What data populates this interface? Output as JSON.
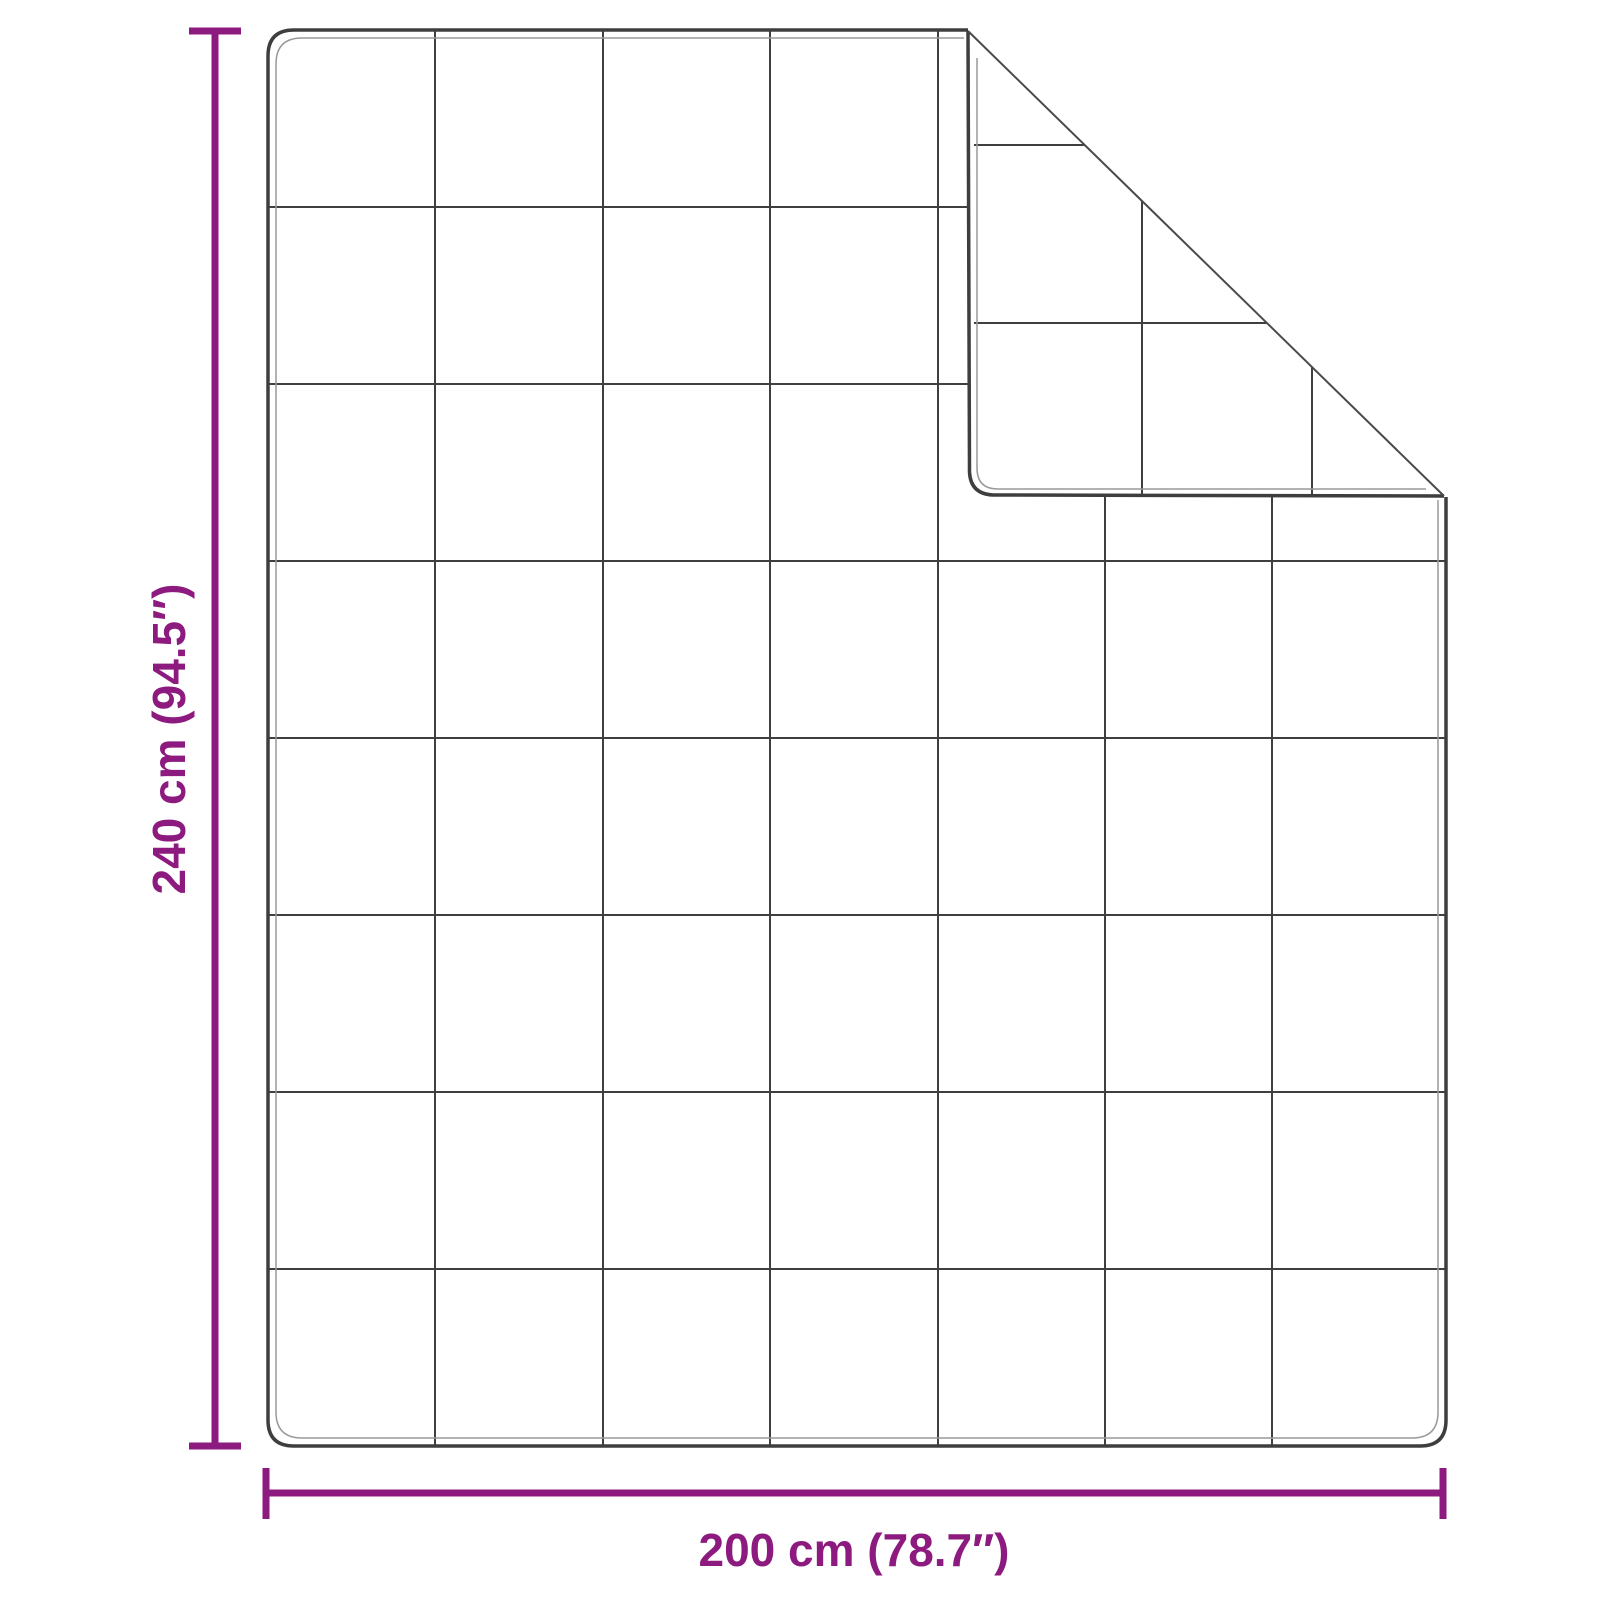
{
  "diagram": {
    "name": "blanket-dimension-diagram",
    "description": "Top view of a quilted blanket with folded top-right corner and dimension lines",
    "height_label": "240 cm (94.5″)",
    "width_label": "200 cm (78.7″)",
    "grid": {
      "columns": 7,
      "rows": 8,
      "flap_squares_visible": true
    },
    "colors": {
      "dimension_accent": "#8C1A7F",
      "blanket_outline": "#3E3E3E",
      "quilt_grid": "#3F3F3F",
      "binding_inner_line": "#999999",
      "background": "#FFFFFF"
    }
  }
}
